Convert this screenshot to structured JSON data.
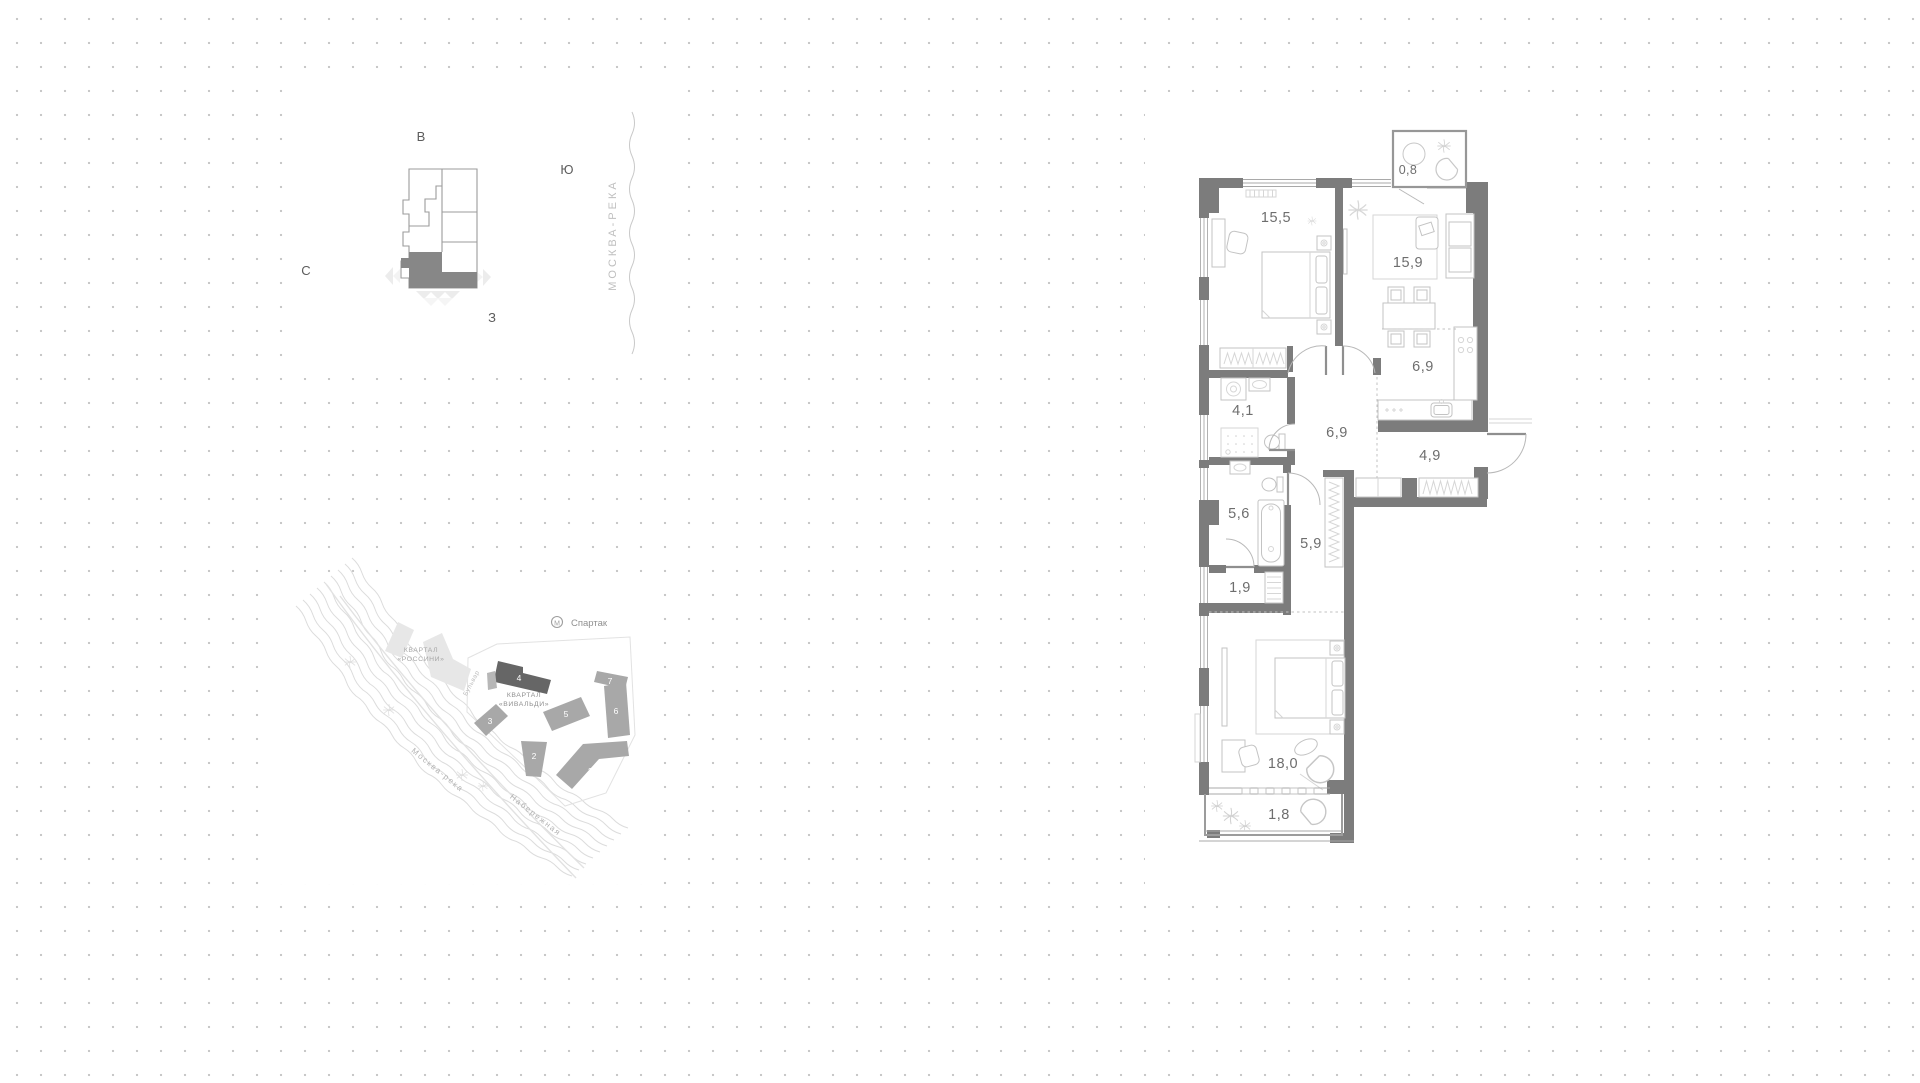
{
  "page": {
    "dot_color": "#c8c8c8",
    "wall_color": "#7c7c7c",
    "label_color": "#6e6e6e"
  },
  "compass": {
    "east": "В",
    "south": "Ю",
    "north": "С",
    "west": "З"
  },
  "river": {
    "label": "МОСКВА-РЕКА"
  },
  "site": {
    "metro_icon": "М",
    "metro_name": "Спартак",
    "rossini_line1": "КВАРТАЛ",
    "rossini_line2": "«РОССИНИ»",
    "vivaldi_line1": "КВАРТАЛ",
    "vivaldi_line2": "«ВИВАЛЬДИ»",
    "boulevard": "Бульвар",
    "river_label": "Москва-река",
    "embankment": "Набережная",
    "buildings": [
      "1",
      "2",
      "3",
      "4",
      "5",
      "6",
      "7"
    ],
    "highlighted_building": "4"
  },
  "plan": {
    "rooms": [
      {
        "name": "balcony-top",
        "area": "0,8"
      },
      {
        "name": "bedroom-1",
        "area": "15,5"
      },
      {
        "name": "living-room",
        "area": "15,9"
      },
      {
        "name": "kitchen",
        "area": "6,9"
      },
      {
        "name": "bathroom-guest",
        "area": "4,1"
      },
      {
        "name": "hallway",
        "area": "6,9"
      },
      {
        "name": "entry-hall",
        "area": "4,9"
      },
      {
        "name": "bathroom-master",
        "area": "5,6"
      },
      {
        "name": "corridor",
        "area": "5,9"
      },
      {
        "name": "storage",
        "area": "1,9"
      },
      {
        "name": "bedroom-2",
        "area": "18,0"
      },
      {
        "name": "balcony-bottom",
        "area": "1,8"
      }
    ]
  }
}
